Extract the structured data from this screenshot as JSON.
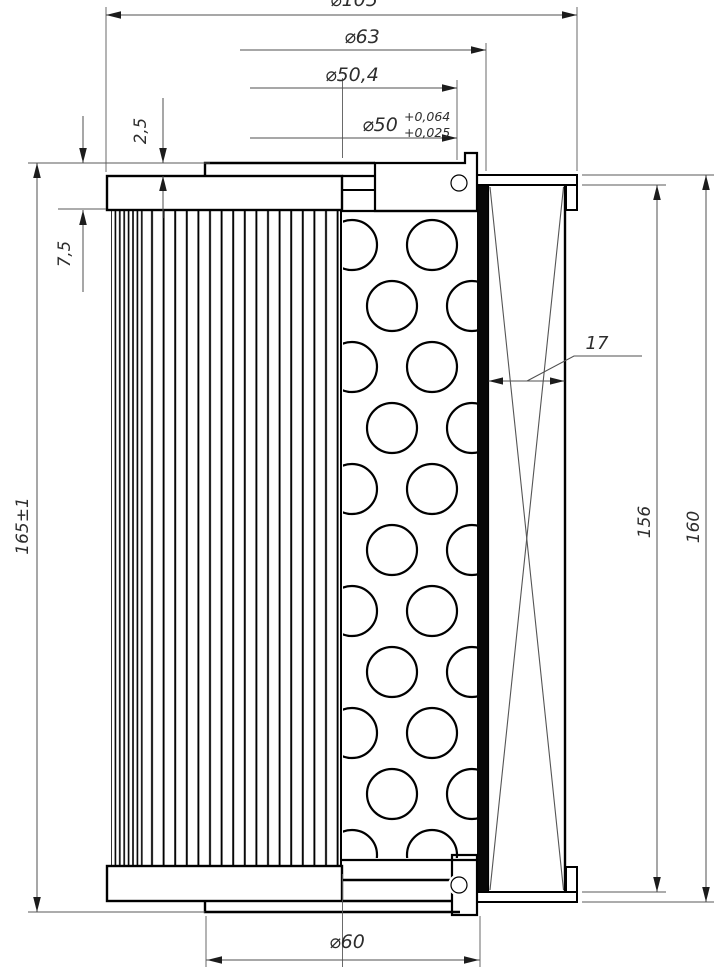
{
  "drawing": {
    "type": "engineering-drawing",
    "subject": "hydraulic-filter-element-half-section",
    "colors": {
      "outline": "#000000",
      "dimension_lines": "#4f4f4f",
      "text": "#2d2d2d",
      "background": "#ffffff"
    },
    "dims": {
      "dia105": "⌀105",
      "dia63": "⌀63",
      "dia50_4": "⌀50,4",
      "dia50": "⌀50",
      "dia50_tol_upper": "+0,064",
      "dia50_tol_lower": "+0,025",
      "collar_height": "2,5",
      "rim_height": "7,5",
      "overall_length": "165±1",
      "media_thickness": "17",
      "inner_length": "156",
      "outer_length": "160",
      "dia60": "⌀60"
    }
  }
}
